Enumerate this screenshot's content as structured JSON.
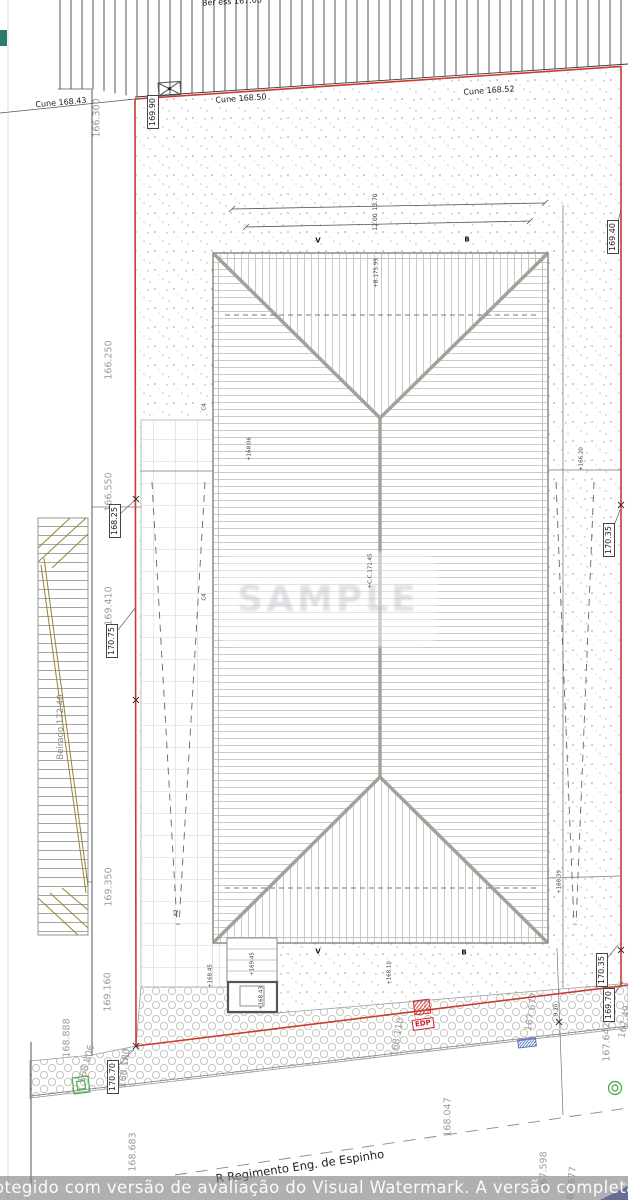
{
  "title": "Site / roof plan - Rua Regimento Eng. de Espinho",
  "colors": {
    "boundary_red": "#cc3a2e",
    "roof_line_gray": "#a2a29c",
    "batten_gray": "#cacac5",
    "stipple_green_gray": "#a7b0a4",
    "pergola_olive": "#968437",
    "edp_red": "#cc2222",
    "utility_blue": "#3f51b5",
    "survey_green": "#4ab04a",
    "label_gray": "#9c9c9c"
  },
  "watermark": {
    "bar_text": "otegido com versão de avaliação do Visual Watermark. A versão completa não deixa essa marc",
    "center_text": "SAMPLE"
  },
  "street": {
    "name": "R Regimento Eng. de Espinho"
  },
  "annotations": [
    {
      "name": "kerb-label-top-cut",
      "t": "Ber ess 167.00",
      "x": 232,
      "y": 2,
      "c": "k",
      "r": -3
    },
    {
      "name": "kerb-label-cune-1",
      "t": "Cune 168.43",
      "x": 61,
      "y": 103,
      "c": "k",
      "r": -5
    },
    {
      "name": "kerb-label-cune-2",
      "t": "Cune 168.50",
      "x": 241,
      "y": 99,
      "c": "k",
      "r": -4
    },
    {
      "name": "kerb-label-cune-3",
      "t": "Cune 168.52",
      "x": 489,
      "y": 91,
      "c": "k",
      "r": -4
    },
    {
      "name": "elev-166300",
      "t": "166.300",
      "x": 97,
      "y": 118,
      "c": "g"
    },
    {
      "name": "elev-166250",
      "t": "166.250",
      "x": 109,
      "y": 360,
      "c": "g"
    },
    {
      "name": "elev-166550",
      "t": "166.550",
      "x": 109,
      "y": 492,
      "c": "g"
    },
    {
      "name": "elev-169410",
      "t": "169.410",
      "x": 109,
      "y": 606,
      "c": "g"
    },
    {
      "name": "elev-169350",
      "t": "169.350",
      "x": 109,
      "y": 887,
      "c": "g"
    },
    {
      "name": "elev-169160",
      "t": "169.160",
      "x": 108,
      "y": 992,
      "c": "g"
    },
    {
      "name": "elev-168888",
      "t": "168.888",
      "x": 67,
      "y": 1038,
      "c": "g"
    },
    {
      "name": "elev-168806",
      "t": "168.806",
      "x": 87,
      "y": 1064,
      "c": "g",
      "r": -75
    },
    {
      "name": "elev-168180",
      "t": "168.180",
      "x": 125,
      "y": 1068,
      "c": "g",
      "r": -83
    },
    {
      "name": "elev-168683",
      "t": "168.683",
      "x": 133,
      "y": 1152,
      "c": "g"
    },
    {
      "name": "elev-168047",
      "t": "168.047",
      "x": 448,
      "y": 1117,
      "c": "g"
    },
    {
      "name": "elev-167598",
      "t": "167.598",
      "x": 544,
      "y": 1171,
      "c": "g"
    },
    {
      "name": "elev-167642",
      "t": "167.642",
      "x": 607,
      "y": 1042,
      "c": "g"
    },
    {
      "name": "elev-167677-a",
      "t": "167.677",
      "x": 532,
      "y": 1012,
      "c": "g",
      "r": -80
    },
    {
      "name": "elev-168110",
      "t": "168.110",
      "x": 398,
      "y": 1037,
      "c": "g",
      "r": -80
    },
    {
      "name": "elev-16749-cut",
      "t": "167.49",
      "x": 625,
      "y": 1022,
      "c": "g",
      "r": -80
    },
    {
      "name": "elev-167677-b",
      "t": "167.677",
      "x": 572,
      "y": 1186,
      "c": "g",
      "r": -85
    },
    {
      "name": "boxed-elev-16990",
      "t": "169.90",
      "x": 153,
      "y": 112,
      "c": "b"
    },
    {
      "name": "boxed-elev-16825",
      "t": "168.25",
      "x": 115,
      "y": 521,
      "c": "b"
    },
    {
      "name": "boxed-elev-17075",
      "t": "170.75",
      "x": 112,
      "y": 641,
      "c": "b"
    },
    {
      "name": "boxed-elev-16940",
      "t": "169.40",
      "x": 613,
      "y": 237,
      "c": "b"
    },
    {
      "name": "boxed-elev-17035-a",
      "t": "170.35",
      "x": 609,
      "y": 540,
      "c": "b"
    },
    {
      "name": "boxed-elev-17035-b",
      "t": "170.35",
      "x": 602,
      "y": 970,
      "c": "b"
    },
    {
      "name": "boxed-elev-16970",
      "t": "169.70",
      "x": 609,
      "y": 1005,
      "c": "b"
    },
    {
      "name": "boxed-elev-17070",
      "t": "170.70",
      "x": 113,
      "y": 1077,
      "c": "b"
    },
    {
      "name": "spot-elev-16806",
      "t": "+168.06",
      "x": 250,
      "y": 449,
      "c": "sp"
    },
    {
      "name": "spot-elev-ridge-17599",
      "t": "+B.175.99",
      "x": 377,
      "y": 273,
      "c": "sp"
    },
    {
      "name": "spot-elev-cc17145",
      "t": "+C.C.171.45",
      "x": 371,
      "y": 571,
      "c": "sp"
    },
    {
      "name": "spot-elev-16620",
      "t": "+166.20",
      "x": 582,
      "y": 459,
      "c": "sp"
    },
    {
      "name": "spot-elev-16839",
      "t": "+168.39",
      "x": 560,
      "y": 882,
      "c": "sp"
    },
    {
      "name": "spot-elev-16810",
      "t": "+168.10",
      "x": 390,
      "y": 973,
      "c": "sp"
    },
    {
      "name": "spot-elev-16945",
      "t": "+169.45",
      "x": 253,
      "y": 964,
      "c": "sp"
    },
    {
      "name": "spot-elev-16845",
      "t": "+168.45",
      "x": 211,
      "y": 976,
      "c": "sp"
    },
    {
      "name": "spot-elev-16843",
      "t": "+168.43",
      "x": 262,
      "y": 998,
      "c": "sp"
    },
    {
      "name": "spot-label-x2",
      "t": "X2",
      "x": 177,
      "y": 913,
      "c": "sp"
    },
    {
      "name": "dim-920",
      "t": "9.20",
      "x": 557,
      "y": 1010,
      "c": "sp"
    },
    {
      "name": "marker-c4-a",
      "t": "C4",
      "x": 205,
      "y": 407,
      "c": "sp"
    },
    {
      "name": "marker-c4-b",
      "t": "C4",
      "x": 205,
      "y": 597,
      "c": "sp"
    },
    {
      "name": "dim-1370",
      "t": "13.70",
      "x": 376,
      "y": 202,
      "c": "dm"
    },
    {
      "name": "dim-1200",
      "t": "12.00",
      "x": 376,
      "y": 222,
      "c": "dm"
    },
    {
      "name": "section-marker-v-top",
      "t": "V",
      "x": 318,
      "y": 241,
      "c": "sm"
    },
    {
      "name": "section-marker-b-top",
      "t": "B",
      "x": 467,
      "y": 240,
      "c": "sm"
    },
    {
      "name": "section-marker-v-bottom",
      "t": "V",
      "x": 318,
      "y": 952,
      "c": "sm"
    },
    {
      "name": "section-marker-b-bottom",
      "t": "B",
      "x": 464,
      "y": 953,
      "c": "sm"
    },
    {
      "name": "street-name",
      "t": "R Regimento Eng. de Espinho",
      "x": 300,
      "y": 1167,
      "c": "st",
      "r": -8.5
    },
    {
      "name": "beirado-label",
      "t": "Beirado 172.40",
      "x": 61,
      "y": 727,
      "c": "be"
    },
    {
      "name": "edp-box-label",
      "t": "EDP",
      "x": 423,
      "y": 1024,
      "c": "edp",
      "r": -8
    }
  ]
}
